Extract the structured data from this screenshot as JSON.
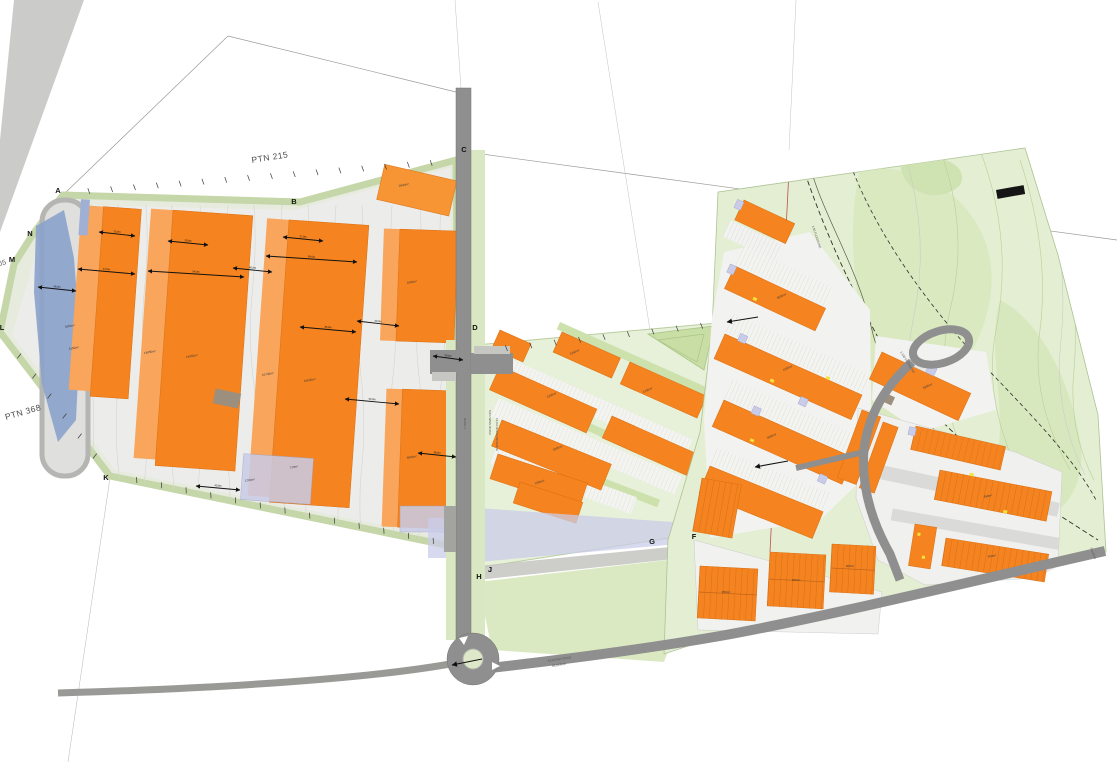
{
  "title": "Site Development Plan",
  "colors": {
    "building_orange": "#F5831F",
    "building_light_orange": "#F9A55B",
    "open_space_green": "#E3EED2",
    "road_gray": "#8F8F8F",
    "water_blue": "#8BA2CB",
    "flood_lavender": "#C9CCE8"
  },
  "labels": {
    "ptn_215": "PTN 215",
    "ptn_368": "PTN 368",
    "ptn_65": "65",
    "road_main_1": "ROAD 1",
    "road_main_2": "8,0m WIDE ROAD",
    "road_main_3": "16,0m ROAD RESERVE",
    "existing_road_1": "EXISTING ROAD",
    "existing_road_2": "RESERVE",
    "floodline_1": "1:50 FLOODLINE",
    "floodline_2": "1:100 FLOODLINE",
    "floodline_3": "Floodline"
  },
  "beacons": [
    {
      "t": "A",
      "x": 58,
      "y": 193
    },
    {
      "t": "B",
      "x": 294,
      "y": 204
    },
    {
      "t": "C",
      "x": 464,
      "y": 152
    },
    {
      "t": "D",
      "x": 475,
      "y": 330
    },
    {
      "t": "F",
      "x": 694,
      "y": 539
    },
    {
      "t": "G",
      "x": 652,
      "y": 544
    },
    {
      "t": "H",
      "x": 479,
      "y": 579
    },
    {
      "t": "J",
      "x": 490,
      "y": 572
    },
    {
      "t": "K",
      "x": 106,
      "y": 480
    },
    {
      "t": "L",
      "x": 2,
      "y": 330
    },
    {
      "t": "M",
      "x": 12,
      "y": 262
    },
    {
      "t": "N",
      "x": 30,
      "y": 236
    }
  ],
  "area_labels": [
    {
      "t": "4950m²",
      "x": 70,
      "y": 327,
      "r": -10
    },
    {
      "t": "5150m²",
      "x": 74,
      "y": 349,
      "r": -10
    },
    {
      "t": "14050m²",
      "x": 150,
      "y": 353,
      "r": -10
    },
    {
      "t": "14650m²",
      "x": 192,
      "y": 357,
      "r": -10
    },
    {
      "t": "16730m²",
      "x": 268,
      "y": 375,
      "r": -10
    },
    {
      "t": "16040m²",
      "x": 310,
      "y": 381,
      "r": -10
    },
    {
      "t": "2945m²",
      "x": 404,
      "y": 186,
      "r": -12
    },
    {
      "t": "1600m²",
      "x": 412,
      "y": 283,
      "r": -10
    },
    {
      "t": "6000m²",
      "x": 412,
      "y": 458,
      "r": -10
    },
    {
      "t": "1200m²",
      "x": 250,
      "y": 481,
      "r": -8
    },
    {
      "t": "720m²",
      "x": 294,
      "y": 468,
      "r": -8
    },
    {
      "t": "2250m²",
      "x": 575,
      "y": 353,
      "r": -25
    },
    {
      "t": "2700m²",
      "x": 648,
      "y": 391,
      "r": -25
    },
    {
      "t": "2250m²",
      "x": 552,
      "y": 396,
      "r": -25
    },
    {
      "t": "2500m²",
      "x": 558,
      "y": 449,
      "r": -23
    },
    {
      "t": "1800m²",
      "x": 540,
      "y": 483,
      "r": -18
    },
    {
      "t": "3500m²",
      "x": 782,
      "y": 297,
      "r": -25
    },
    {
      "t": "4200m²",
      "x": 788,
      "y": 369,
      "r": -25
    },
    {
      "t": "4000m²",
      "x": 772,
      "y": 437,
      "r": -23
    },
    {
      "t": "2800m²",
      "x": 928,
      "y": 387,
      "r": -25
    },
    {
      "t": "450m²",
      "x": 988,
      "y": 497,
      "r": -10
    },
    {
      "t": "450m²",
      "x": 992,
      "y": 557,
      "r": -8
    },
    {
      "t": "350m²",
      "x": 726,
      "y": 593,
      "r": 0
    },
    {
      "t": "350m²",
      "x": 796,
      "y": 581,
      "r": 0
    },
    {
      "t": "300m²",
      "x": 850,
      "y": 567,
      "r": 0
    }
  ],
  "dimensions": [
    {
      "x1": 99,
      "y1": 232,
      "x2": 135,
      "y2": 236,
      "t": "25,0m"
    },
    {
      "x1": 78,
      "y1": 269,
      "x2": 135,
      "y2": 274,
      "t": "41,0m"
    },
    {
      "x1": 38,
      "y1": 287,
      "x2": 76,
      "y2": 291,
      "t": "36,0m"
    },
    {
      "x1": 148,
      "y1": 271,
      "x2": 244,
      "y2": 277,
      "t": "54,0m"
    },
    {
      "x1": 168,
      "y1": 241,
      "x2": 208,
      "y2": 245,
      "t": "29,0m"
    },
    {
      "x1": 266,
      "y1": 256,
      "x2": 357,
      "y2": 262,
      "t": "54,0m"
    },
    {
      "x1": 283,
      "y1": 237,
      "x2": 323,
      "y2": 241,
      "t": "27,0m"
    },
    {
      "x1": 233,
      "y1": 268,
      "x2": 272,
      "y2": 272,
      "t": "40,0m"
    },
    {
      "x1": 300,
      "y1": 327,
      "x2": 356,
      "y2": 332,
      "t": "35,0m"
    },
    {
      "x1": 357,
      "y1": 321,
      "x2": 399,
      "y2": 326,
      "t": "40,0m"
    },
    {
      "x1": 345,
      "y1": 399,
      "x2": 399,
      "y2": 404,
      "t": "44,0m"
    },
    {
      "x1": 433,
      "y1": 356,
      "x2": 463,
      "y2": 360,
      "t": "30,0m"
    },
    {
      "x1": 418,
      "y1": 453,
      "x2": 456,
      "y2": 457,
      "t": "38,0m"
    },
    {
      "x1": 196,
      "y1": 486,
      "x2": 240,
      "y2": 490,
      "t": "40,0m"
    }
  ],
  "pointers": [
    {
      "x1": 758,
      "y1": 317,
      "x2": 727,
      "y2": 322
    },
    {
      "x1": 788,
      "y1": 461,
      "x2": 755,
      "y2": 467
    },
    {
      "x1": 482,
      "y1": 659,
      "x2": 452,
      "y2": 665
    }
  ],
  "ticks": [
    {
      "x1": 66,
      "y1": 193,
      "x2": 454,
      "y2": 161,
      "n": 16
    },
    {
      "x1": 458,
      "y1": 546,
      "x2": 112,
      "y2": 475,
      "n": 13
    },
    {
      "x1": 110,
      "y1": 476,
      "x2": 4,
      "y2": 336,
      "n": 6
    },
    {
      "x1": 482,
      "y1": 351,
      "x2": 726,
      "y2": 323,
      "n": 9
    }
  ]
}
